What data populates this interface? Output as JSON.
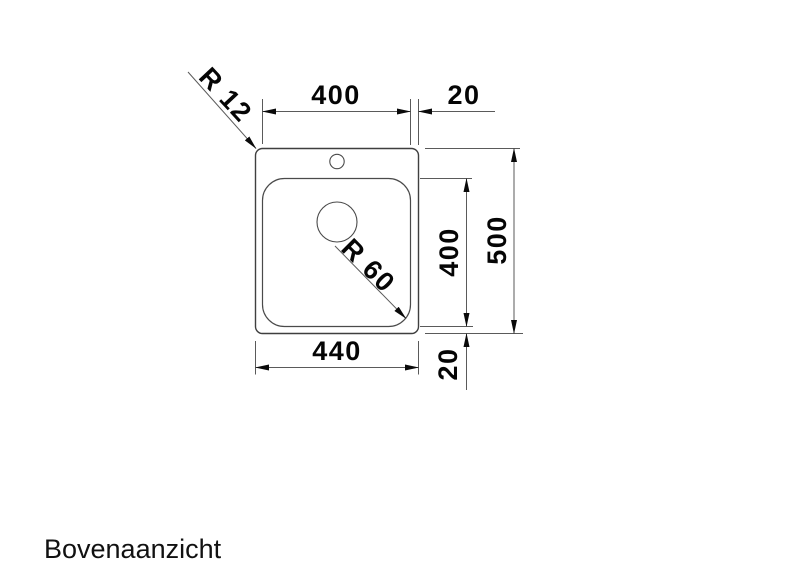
{
  "page": {
    "background": "#ffffff",
    "caption": "Bovenaanzicht"
  },
  "drawing": {
    "type": "technical-top-view-sink",
    "line_color": "#3f3f3f",
    "dim_line_color": "#5a5a5a",
    "text_color": "#050505",
    "dimensions": {
      "bowl_width": "400",
      "right_margin": "20",
      "total_width": "440",
      "bowl_height": "400",
      "total_height": "500",
      "bottom_margin": "20",
      "outer_corner_radius": "R 12",
      "bowl_corner_radius": "R 60"
    }
  }
}
